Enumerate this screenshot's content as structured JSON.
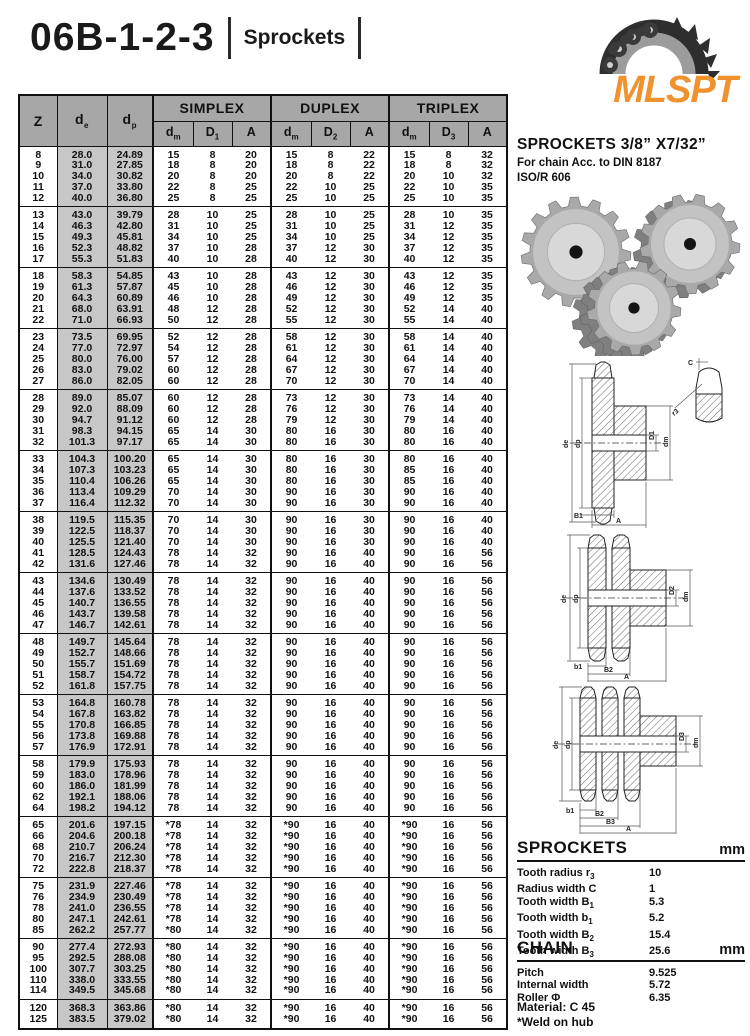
{
  "page": {
    "title": "06B-1-2-3",
    "subtitle": "Sprockets"
  },
  "logo": {
    "text": "MLSPT",
    "color": "#f0922e"
  },
  "right_panel": {
    "heading": "SPROCKETS 3/8” X7/32”",
    "sub1": "For chain Acc. to DIN 8187",
    "sub2": "ISO/R 606",
    "sprockets_section": {
      "title": "SPROCKETS",
      "unit": "mm",
      "items": [
        {
          "label": "Tooth radius r",
          "sub": "3",
          "value": "10"
        },
        {
          "label": "Radius width C",
          "sub": "",
          "value": "1"
        },
        {
          "label": "Tooth width B",
          "sub": "1",
          "value": "5.3"
        },
        {
          "label": "Tooth width b",
          "sub": "1",
          "value": "5.2"
        },
        {
          "label": "Tooth width B",
          "sub": "2",
          "value": "15.4"
        },
        {
          "label": "Tooth width B",
          "sub": "3",
          "value": "25.6"
        }
      ]
    },
    "chain_section": {
      "title": "CHAIN",
      "unit": "mm",
      "items": [
        {
          "label": "Pitch",
          "sub": "",
          "value": "9.525"
        },
        {
          "label": "Internal width",
          "sub": "",
          "value": "5.72"
        },
        {
          "label": "Roller Φ",
          "sub": "",
          "value": "6.35"
        }
      ]
    },
    "material": "Material: C 45",
    "weld_note": "*Weld on hub"
  },
  "diagrams": {
    "simplex": {
      "left1": "de",
      "left2": "dp",
      "right1": "D1",
      "right2": "dm",
      "bottom1": "B1",
      "bottom2": "A",
      "tooth_c": "C",
      "tooth_r": "r3"
    },
    "duplex": {
      "left1": "de",
      "left2": "dp",
      "right1": "D2",
      "right2": "dm",
      "bottom1": "b1",
      "bottom2": "B2",
      "bottom3": "A"
    },
    "triplex": {
      "left1": "de",
      "left2": "dp",
      "right1": "D3",
      "right2": "dm",
      "bottom1": "b1",
      "bottom2": "B2",
      "bottom3": "B3",
      "bottom4": "A"
    }
  },
  "table": {
    "header": {
      "z": "Z",
      "de": {
        "b": "d",
        "s": "e"
      },
      "dp": {
        "b": "d",
        "s": "p"
      },
      "simplex": "SIMPLEX",
      "duplex": "DUPLEX",
      "triplex": "TRIPLEX",
      "sub_cols": [
        {
          "b": "d",
          "s": "m"
        },
        {
          "b": "D",
          "s": "1"
        },
        {
          "b": "A",
          "s": ""
        },
        {
          "b": "d",
          "s": "m"
        },
        {
          "b": "D",
          "s": "2"
        },
        {
          "b": "A",
          "s": ""
        },
        {
          "b": "d",
          "s": "m"
        },
        {
          "b": "D",
          "s": "3"
        },
        {
          "b": "A",
          "s": ""
        }
      ]
    },
    "groups": [
      [
        [
          "8",
          "28.0",
          "24.89",
          "15",
          "8",
          "20",
          "15",
          "8",
          "22",
          "15",
          "8",
          "32"
        ],
        [
          "9",
          "31.0",
          "27.85",
          "18",
          "8",
          "20",
          "18",
          "8",
          "22",
          "18",
          "8",
          "32"
        ],
        [
          "10",
          "34.0",
          "30.82",
          "20",
          "8",
          "20",
          "20",
          "8",
          "22",
          "20",
          "10",
          "32"
        ],
        [
          "11",
          "37.0",
          "33.80",
          "22",
          "8",
          "25",
          "22",
          "10",
          "25",
          "22",
          "10",
          "35"
        ],
        [
          "12",
          "40.0",
          "36.80",
          "25",
          "8",
          "25",
          "25",
          "10",
          "25",
          "25",
          "10",
          "35"
        ]
      ],
      [
        [
          "13",
          "43.0",
          "39.79",
          "28",
          "10",
          "25",
          "28",
          "10",
          "25",
          "28",
          "10",
          "35"
        ],
        [
          "14",
          "46.3",
          "42.80",
          "31",
          "10",
          "25",
          "31",
          "10",
          "25",
          "31",
          "12",
          "35"
        ],
        [
          "15",
          "49.3",
          "45.81",
          "34",
          "10",
          "25",
          "34",
          "10",
          "25",
          "34",
          "12",
          "35"
        ],
        [
          "16",
          "52.3",
          "48.82",
          "37",
          "10",
          "28",
          "37",
          "12",
          "30",
          "37",
          "12",
          "35"
        ],
        [
          "17",
          "55.3",
          "51.83",
          "40",
          "10",
          "28",
          "40",
          "12",
          "30",
          "40",
          "12",
          "35"
        ]
      ],
      [
        [
          "18",
          "58.3",
          "54.85",
          "43",
          "10",
          "28",
          "43",
          "12",
          "30",
          "43",
          "12",
          "35"
        ],
        [
          "19",
          "61.3",
          "57.87",
          "45",
          "10",
          "28",
          "46",
          "12",
          "30",
          "46",
          "12",
          "35"
        ],
        [
          "20",
          "64.3",
          "60.89",
          "46",
          "10",
          "28",
          "49",
          "12",
          "30",
          "49",
          "12",
          "35"
        ],
        [
          "21",
          "68.0",
          "63.91",
          "48",
          "12",
          "28",
          "52",
          "12",
          "30",
          "52",
          "14",
          "40"
        ],
        [
          "22",
          "71.0",
          "66.93",
          "50",
          "12",
          "28",
          "55",
          "12",
          "30",
          "55",
          "14",
          "40"
        ]
      ],
      [
        [
          "23",
          "73.5",
          "69.95",
          "52",
          "12",
          "28",
          "58",
          "12",
          "30",
          "58",
          "14",
          "40"
        ],
        [
          "24",
          "77.0",
          "72.97",
          "54",
          "12",
          "28",
          "61",
          "12",
          "30",
          "61",
          "14",
          "40"
        ],
        [
          "25",
          "80.0",
          "76.00",
          "57",
          "12",
          "28",
          "64",
          "12",
          "30",
          "64",
          "14",
          "40"
        ],
        [
          "26",
          "83.0",
          "79.02",
          "60",
          "12",
          "28",
          "67",
          "12",
          "30",
          "67",
          "14",
          "40"
        ],
        [
          "27",
          "86.0",
          "82.05",
          "60",
          "12",
          "28",
          "70",
          "12",
          "30",
          "70",
          "14",
          "40"
        ]
      ],
      [
        [
          "28",
          "89.0",
          "85.07",
          "60",
          "12",
          "28",
          "73",
          "12",
          "30",
          "73",
          "14",
          "40"
        ],
        [
          "29",
          "92.0",
          "88.09",
          "60",
          "12",
          "28",
          "76",
          "12",
          "30",
          "76",
          "14",
          "40"
        ],
        [
          "30",
          "94.7",
          "91.12",
          "60",
          "12",
          "28",
          "79",
          "12",
          "30",
          "79",
          "14",
          "40"
        ],
        [
          "31",
          "98.3",
          "94.15",
          "65",
          "14",
          "30",
          "80",
          "16",
          "30",
          "80",
          "16",
          "40"
        ],
        [
          "32",
          "101.3",
          "97.17",
          "65",
          "14",
          "30",
          "80",
          "16",
          "30",
          "80",
          "16",
          "40"
        ]
      ],
      [
        [
          "33",
          "104.3",
          "100.20",
          "65",
          "14",
          "30",
          "80",
          "16",
          "30",
          "80",
          "16",
          "40"
        ],
        [
          "34",
          "107.3",
          "103.23",
          "65",
          "14",
          "30",
          "80",
          "16",
          "30",
          "85",
          "16",
          "40"
        ],
        [
          "35",
          "110.4",
          "106.26",
          "65",
          "14",
          "30",
          "80",
          "16",
          "30",
          "85",
          "16",
          "40"
        ],
        [
          "36",
          "113.4",
          "109.29",
          "70",
          "14",
          "30",
          "90",
          "16",
          "30",
          "90",
          "16",
          "40"
        ],
        [
          "37",
          "116.4",
          "112.32",
          "70",
          "14",
          "30",
          "90",
          "16",
          "30",
          "90",
          "16",
          "40"
        ]
      ],
      [
        [
          "38",
          "119.5",
          "115.35",
          "70",
          "14",
          "30",
          "90",
          "16",
          "30",
          "90",
          "16",
          "40"
        ],
        [
          "39",
          "122.5",
          "118.37",
          "70",
          "14",
          "30",
          "90",
          "16",
          "30",
          "90",
          "16",
          "40"
        ],
        [
          "40",
          "125.5",
          "121.40",
          "70",
          "14",
          "30",
          "90",
          "16",
          "30",
          "90",
          "16",
          "40"
        ],
        [
          "41",
          "128.5",
          "124.43",
          "78",
          "14",
          "32",
          "90",
          "16",
          "40",
          "90",
          "16",
          "56"
        ],
        [
          "42",
          "131.6",
          "127.46",
          "78",
          "14",
          "32",
          "90",
          "16",
          "40",
          "90",
          "16",
          "56"
        ]
      ],
      [
        [
          "43",
          "134.6",
          "130.49",
          "78",
          "14",
          "32",
          "90",
          "16",
          "40",
          "90",
          "16",
          "56"
        ],
        [
          "44",
          "137.6",
          "133.52",
          "78",
          "14",
          "32",
          "90",
          "16",
          "40",
          "90",
          "16",
          "56"
        ],
        [
          "45",
          "140.7",
          "136.55",
          "78",
          "14",
          "32",
          "90",
          "16",
          "40",
          "90",
          "16",
          "56"
        ],
        [
          "46",
          "143.7",
          "139.58",
          "78",
          "14",
          "32",
          "90",
          "16",
          "40",
          "90",
          "16",
          "56"
        ],
        [
          "47",
          "146.7",
          "142.61",
          "78",
          "14",
          "32",
          "90",
          "16",
          "40",
          "90",
          "16",
          "56"
        ]
      ],
      [
        [
          "48",
          "149.7",
          "145.64",
          "78",
          "14",
          "32",
          "90",
          "16",
          "40",
          "90",
          "16",
          "56"
        ],
        [
          "49",
          "152.7",
          "148.66",
          "78",
          "14",
          "32",
          "90",
          "16",
          "40",
          "90",
          "16",
          "56"
        ],
        [
          "50",
          "155.7",
          "151.69",
          "78",
          "14",
          "32",
          "90",
          "16",
          "40",
          "90",
          "16",
          "56"
        ],
        [
          "51",
          "158.7",
          "154.72",
          "78",
          "14",
          "32",
          "90",
          "16",
          "40",
          "90",
          "16",
          "56"
        ],
        [
          "52",
          "161.8",
          "157.75",
          "78",
          "14",
          "32",
          "90",
          "16",
          "40",
          "90",
          "16",
          "56"
        ]
      ],
      [
        [
          "53",
          "164.8",
          "160.78",
          "78",
          "14",
          "32",
          "90",
          "16",
          "40",
          "90",
          "16",
          "56"
        ],
        [
          "54",
          "167.8",
          "163.82",
          "78",
          "14",
          "32",
          "90",
          "16",
          "40",
          "90",
          "16",
          "56"
        ],
        [
          "55",
          "170.8",
          "166.85",
          "78",
          "14",
          "32",
          "90",
          "16",
          "40",
          "90",
          "16",
          "56"
        ],
        [
          "56",
          "173.8",
          "169.88",
          "78",
          "14",
          "32",
          "90",
          "16",
          "40",
          "90",
          "16",
          "56"
        ],
        [
          "57",
          "176.9",
          "172.91",
          "78",
          "14",
          "32",
          "90",
          "16",
          "40",
          "90",
          "16",
          "56"
        ]
      ],
      [
        [
          "58",
          "179.9",
          "175.93",
          "78",
          "14",
          "32",
          "90",
          "16",
          "40",
          "90",
          "16",
          "56"
        ],
        [
          "59",
          "183.0",
          "178.96",
          "78",
          "14",
          "32",
          "90",
          "16",
          "40",
          "90",
          "16",
          "56"
        ],
        [
          "60",
          "186.0",
          "181.99",
          "78",
          "14",
          "32",
          "90",
          "16",
          "40",
          "90",
          "16",
          "56"
        ],
        [
          "62",
          "192.1",
          "188.06",
          "78",
          "14",
          "32",
          "90",
          "16",
          "40",
          "90",
          "16",
          "56"
        ],
        [
          "64",
          "198.2",
          "194.12",
          "78",
          "14",
          "32",
          "90",
          "16",
          "40",
          "90",
          "16",
          "56"
        ]
      ],
      [
        [
          "65",
          "201.6",
          "197.15",
          "*78",
          "14",
          "32",
          "*90",
          "16",
          "40",
          "*90",
          "16",
          "56"
        ],
        [
          "66",
          "204.6",
          "200.18",
          "*78",
          "14",
          "32",
          "*90",
          "16",
          "40",
          "*90",
          "16",
          "56"
        ],
        [
          "68",
          "210.7",
          "206.24",
          "*78",
          "14",
          "32",
          "*90",
          "16",
          "40",
          "*90",
          "16",
          "56"
        ],
        [
          "70",
          "216.7",
          "212.30",
          "*78",
          "14",
          "32",
          "*90",
          "16",
          "40",
          "*90",
          "16",
          "56"
        ],
        [
          "72",
          "222.8",
          "218.37",
          "*78",
          "14",
          "32",
          "*90",
          "16",
          "40",
          "*90",
          "16",
          "56"
        ]
      ],
      [
        [
          "75",
          "231.9",
          "227.46",
          "*78",
          "14",
          "32",
          "*90",
          "16",
          "40",
          "*90",
          "16",
          "56"
        ],
        [
          "76",
          "234.9",
          "230.49",
          "*78",
          "14",
          "32",
          "*90",
          "16",
          "40",
          "*90",
          "16",
          "56"
        ],
        [
          "78",
          "241.0",
          "236.55",
          "*78",
          "14",
          "32",
          "*90",
          "16",
          "40",
          "*90",
          "16",
          "56"
        ],
        [
          "80",
          "247.1",
          "242.61",
          "*78",
          "14",
          "32",
          "*90",
          "16",
          "40",
          "*90",
          "16",
          "56"
        ],
        [
          "85",
          "262.2",
          "257.77",
          "*80",
          "14",
          "32",
          "*90",
          "16",
          "40",
          "*90",
          "16",
          "56"
        ]
      ],
      [
        [
          "90",
          "277.4",
          "272.93",
          "*80",
          "14",
          "32",
          "*90",
          "16",
          "40",
          "*90",
          "16",
          "56"
        ],
        [
          "95",
          "292.5",
          "288.08",
          "*80",
          "14",
          "32",
          "*90",
          "16",
          "40",
          "*90",
          "16",
          "56"
        ],
        [
          "100",
          "307.7",
          "303.25",
          "*80",
          "14",
          "32",
          "*90",
          "16",
          "40",
          "*90",
          "16",
          "56"
        ],
        [
          "110",
          "338.0",
          "333.55",
          "*80",
          "14",
          "32",
          "*90",
          "16",
          "40",
          "*90",
          "16",
          "56"
        ],
        [
          "114",
          "349.5",
          "345.68",
          "*80",
          "14",
          "32",
          "*90",
          "16",
          "40",
          "*90",
          "16",
          "56"
        ]
      ],
      [
        [
          "120",
          "368.3",
          "363.86",
          "*80",
          "14",
          "32",
          "*90",
          "16",
          "40",
          "*90",
          "16",
          "56"
        ],
        [
          "125",
          "383.5",
          "379.02",
          "*80",
          "14",
          "32",
          "*90",
          "16",
          "40",
          "*90",
          "16",
          "56"
        ]
      ]
    ]
  }
}
